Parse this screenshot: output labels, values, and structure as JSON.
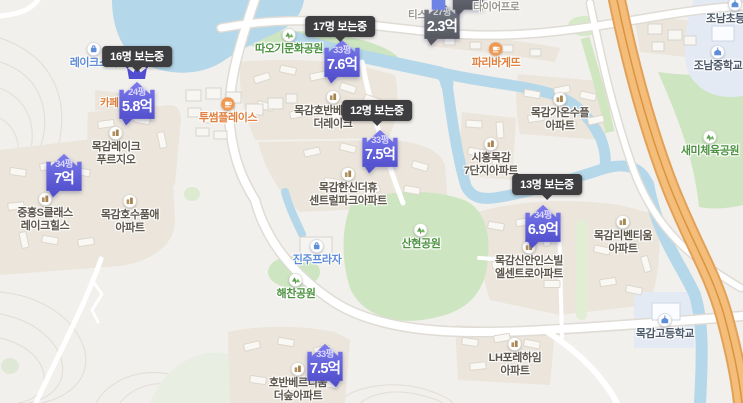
{
  "markers": [
    {
      "area": "24평",
      "price": "5.8억",
      "viewers": "16명 보는중",
      "crowned": true,
      "variant": "primary"
    },
    {
      "area": "33평",
      "price": "7.6억",
      "viewers": "17명 보는중",
      "crowned": false,
      "variant": "primary"
    },
    {
      "area": "33평",
      "price": "7.5억",
      "viewers": "12명 보는중",
      "crowned": false,
      "variant": "primary"
    },
    {
      "area": "34평",
      "price": "6.9억",
      "viewers": "13명 보는중",
      "crowned": false,
      "variant": "primary"
    },
    {
      "area": "33평",
      "price": "7.5억",
      "viewers": "",
      "crowned": false,
      "variant": "primary"
    },
    {
      "area": "34평",
      "price": "7억",
      "viewers": "",
      "crowned": false,
      "variant": "primary"
    },
    {
      "area": "27평",
      "price": "2.3억",
      "viewers": "",
      "crowned": false,
      "variant": "muted"
    }
  ],
  "apartments": [
    {
      "lines": [
        "목감레이크",
        "푸르지오"
      ]
    },
    {
      "lines": [
        "중흥S클래스",
        "레이크힐스"
      ]
    },
    {
      "lines": [
        "목감호수품애",
        "아파트"
      ]
    },
    {
      "lines": [
        "목감호반베르디움",
        "더레이크"
      ]
    },
    {
      "lines": [
        "목감한신더휴",
        "센트럴파크아파트"
      ]
    },
    {
      "lines": [
        "시흥목감",
        "7단지아파트"
      ]
    },
    {
      "lines": [
        "목감가온수플",
        "아파트"
      ]
    },
    {
      "lines": [
        "목감리벤티움",
        "아파트"
      ]
    },
    {
      "lines": [
        "목감신안인스빌",
        "엘센트로아파트"
      ]
    },
    {
      "lines": [
        "LH포레하임",
        "아파트"
      ]
    },
    {
      "lines": [
        "호반베르디움",
        "더숲아파트"
      ]
    }
  ],
  "parks": [
    {
      "name": "따오기문화공원"
    },
    {
      "name": "산현공원"
    },
    {
      "name": "해찬공원"
    },
    {
      "name": "새미체육공원"
    }
  ],
  "schools": [
    {
      "name": "조남초등학교"
    },
    {
      "name": "조남중학교"
    },
    {
      "name": "목감고등학교"
    }
  ],
  "shops": [
    {
      "name": "투썸플레이스"
    },
    {
      "name": "파리바게뜨"
    }
  ],
  "places": [
    {
      "name": "레이크스타"
    },
    {
      "name": "진주프라자"
    }
  ],
  "partial_labels": [
    {
      "name": "카페"
    },
    {
      "name": "티스"
    },
    {
      "name": "타이어프로"
    }
  ],
  "colors": {
    "marker_primary_top": "#7d7bed",
    "marker_primary_bottom": "#5250cd",
    "marker_muted_top": "#7b7f89",
    "marker_muted_bottom": "#54575f",
    "badge_bg": "#3e3e40",
    "water": "#b4d7e9",
    "park_green": "#cde5c0",
    "highway_orange": "#f4bd79",
    "school_zone": "#e3eaf4"
  }
}
